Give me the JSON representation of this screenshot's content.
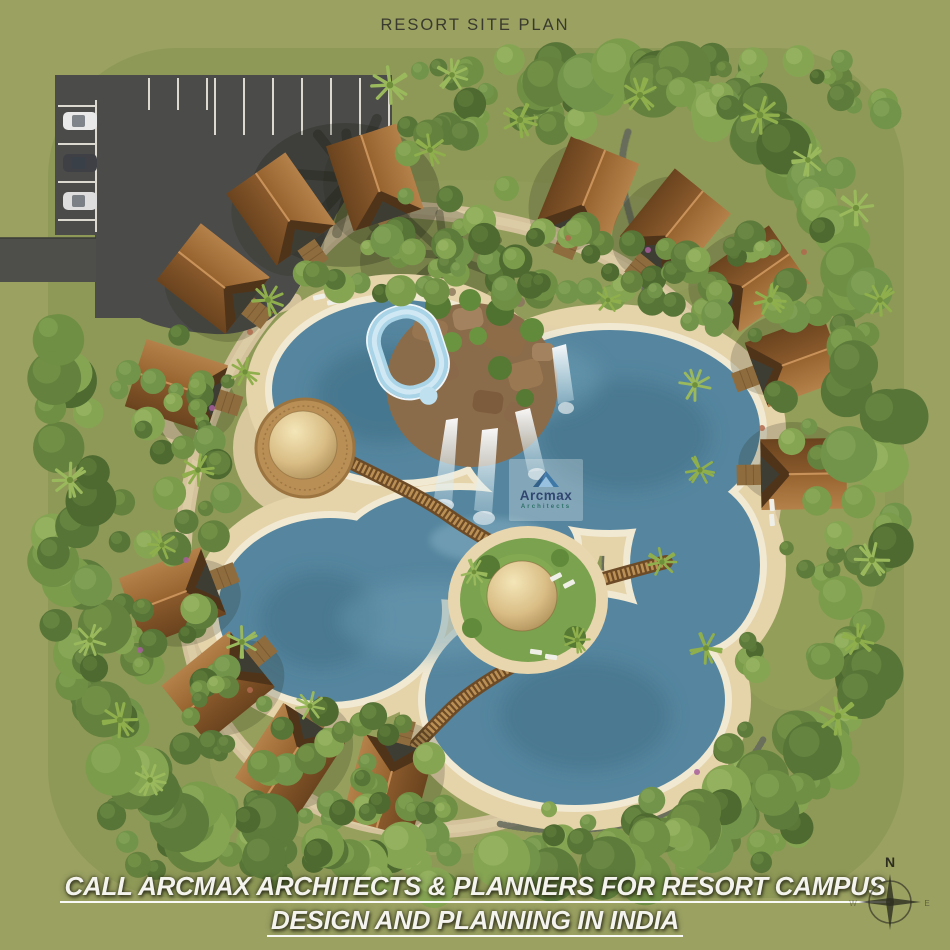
{
  "page": {
    "title": "RESORT SITE PLAN"
  },
  "watermark": {
    "brand": "Arcmax",
    "subtitle": "Architects"
  },
  "footer": {
    "line1": "CALL ARCMAX ARCHITECTS & PLANNERS FOR RESORT CAMPUS",
    "line2": "DESIGN AND PLANNING IN INDIA"
  },
  "compass": {
    "north": "N",
    "east": "E",
    "west": "W"
  },
  "colors": {
    "background": "#9aa161",
    "site_grass": "#8e9957",
    "water": "#56869f",
    "water_deep": "#3b6b84",
    "water_light": "#6fa3ba",
    "sand": "#e5d3aa",
    "path": "#d3c29b",
    "pebble_path": "#63675c",
    "asphalt": "#4b4b49",
    "roof_light": "#a87843",
    "roof_dark": "#7c4e24",
    "wood": "#9a7340",
    "thatch_light": "#f2e2b2",
    "thatch_dark": "#9c7d47",
    "slide": "#a9d3e6",
    "title_text": "#3a3a2e",
    "footer_text": "#f4f3ee",
    "compass_ink": "#2e2e20",
    "car_colors": [
      "#e9e9e9",
      "#3f4045",
      "#dedede"
    ],
    "foliage": [
      "#4e6a30",
      "#587538",
      "#64823d",
      "#6f8f44",
      "#7b9c4b",
      "#86a553",
      "#5d7b3b",
      "#71944a"
    ],
    "foliage_light": [
      "#64823f",
      "#6f8f47",
      "#7b9c4e",
      "#86a757",
      "#93b160",
      "#9fbc6a",
      "#74924a",
      "#88a85c"
    ],
    "palm": "#8fae4c"
  }
}
